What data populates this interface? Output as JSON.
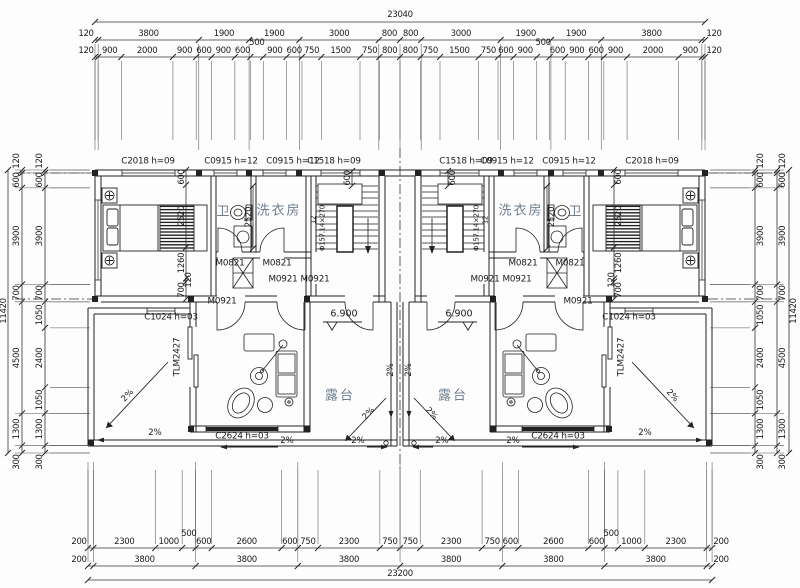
{
  "drawing": {
    "type": "architectural-floor-plan",
    "overall_width_mm": "23040",
    "overall_depth_mm": "11420",
    "terrace_width_mm": "23200",
    "level_note": "6.900"
  },
  "colors": {
    "line": "#222222",
    "room_text": "#6e7e8e"
  },
  "dim_rows": [
    {
      "id": "top-total",
      "dir": "h",
      "y": 22,
      "x0": 95,
      "s": 0.026476,
      "vals": [
        23040
      ],
      "lo": -7
    },
    {
      "id": "top-row1",
      "dir": "h",
      "y": 40,
      "x0": 95,
      "s": 0.026476,
      "lo": -6,
      "out": true,
      "ext": [
        44,
        150
      ],
      "vals": [
        120,
        3800,
        1900,
        1900,
        3000,
        800,
        800,
        3000,
        1900,
        1900,
        3800,
        120
      ]
    },
    {
      "id": "top-row2",
      "dir": "h",
      "y": 57,
      "x0": 95,
      "s": 0.025804,
      "lo": -6,
      "out": true,
      "ext": [
        61,
        140
      ],
      "raised": [
        7,
        20
      ],
      "vals": [
        120,
        900,
        2000,
        900,
        600,
        900,
        600,
        500,
        900,
        600,
        750,
        1500,
        750,
        800,
        800,
        750,
        1500,
        750,
        600,
        900,
        500,
        600,
        900,
        600,
        900,
        2000,
        900,
        120
      ]
    },
    {
      "id": "bottom-row1",
      "dir": "h",
      "y": 548,
      "x0": 88,
      "s": 0.0269,
      "lo": -6,
      "out": true,
      "ext": [
        470,
        544
      ],
      "raised": [
        3,
        16
      ],
      "vals": [
        200,
        2300,
        1000,
        500,
        600,
        2600,
        600,
        750,
        2300,
        750,
        750,
        2300,
        750,
        600,
        2600,
        600,
        500,
        1000,
        2300,
        200
      ]
    },
    {
      "id": "bottom-row2",
      "dir": "h",
      "y": 566,
      "x0": 88,
      "s": 0.0269,
      "lo": -6,
      "out": true,
      "ext": [
        462,
        562
      ],
      "vals": [
        200,
        3800,
        3800,
        3800,
        3800,
        3800,
        3800,
        200
      ]
    },
    {
      "id": "bottom-total",
      "dir": "h",
      "y": 580,
      "x0": 88,
      "s": 0.0269,
      "vals": [
        23200
      ],
      "lo": -6
    },
    {
      "id": "left-inner",
      "dir": "v",
      "x": 45,
      "y0": 170,
      "s": 0.02478,
      "lo": -5,
      "out": true,
      "ext": [
        50,
        90
      ],
      "vals": [
        120,
        600,
        3900,
        700,
        1050,
        2400,
        1050,
        1300,
        300
      ]
    },
    {
      "id": "left-outer",
      "dir": "v",
      "x": 22,
      "y0": 170,
      "s": 0.02478,
      "lo": -5,
      "out": true,
      "ext": [
        15,
        90
      ],
      "vals": [
        120,
        600,
        3900,
        700,
        4500,
        1300,
        300
      ]
    },
    {
      "id": "left-total",
      "dir": "v",
      "x": 8,
      "y0": 170,
      "s": 0.02478,
      "vals": [
        11420
      ],
      "lo": -4
    },
    {
      "id": "right-inner",
      "dir": "v",
      "x": 755,
      "y0": 170,
      "s": 0.02478,
      "lo": 6,
      "out": true,
      "ext": [
        710,
        750
      ],
      "vals": [
        120,
        600,
        3900,
        700,
        1050,
        2400,
        1050,
        1300,
        300
      ]
    },
    {
      "id": "right-outer",
      "dir": "v",
      "x": 777,
      "y0": 170,
      "s": 0.02478,
      "lo": 6,
      "out": true,
      "ext": [
        710,
        784
      ],
      "vals": [
        120,
        600,
        3900,
        700,
        4500,
        1300,
        300
      ]
    },
    {
      "id": "right-total",
      "dir": "v",
      "x": 789,
      "y0": 170,
      "s": 0.02478,
      "vals": [
        11420
      ],
      "lo": 5
    },
    {
      "id": "unitL-chain",
      "dir": "v",
      "x": 186,
      "y0": 170,
      "s": 0.0248,
      "lo": -4,
      "raised": [
        3
      ],
      "vals": [
        600,
        2520,
        1260,
        120,
        700
      ]
    },
    {
      "id": "unitR-chain",
      "dir": "v",
      "x": 614,
      "y0": 170,
      "s": 0.0248,
      "lo": 5,
      "raised": [
        3
      ],
      "vals": [
        600,
        2520,
        1260,
        120,
        700
      ]
    },
    {
      "id": "unitL-2520",
      "dir": "v",
      "x": 253,
      "y0": 186,
      "s": 0.0248,
      "lo": -4,
      "vals": [
        2520
      ]
    },
    {
      "id": "unitR-2520",
      "dir": "v",
      "x": 547,
      "y0": 186,
      "s": 0.0248,
      "lo": 5,
      "vals": [
        2520
      ]
    },
    {
      "id": "unitL-600",
      "dir": "v",
      "x": 352,
      "y0": 171,
      "s": 0.0248,
      "lo": -4,
      "vals": [
        600
      ]
    },
    {
      "id": "unitR-600",
      "dir": "v",
      "x": 448,
      "y0": 171,
      "s": 0.0248,
      "lo": 5,
      "vals": [
        600
      ]
    }
  ],
  "labels": [
    {
      "t": "C2018 h=09",
      "x": 148,
      "y": 162,
      "cls": "tag",
      "n": "window-tag"
    },
    {
      "t": "C0915 h=12",
      "x": 231,
      "y": 162,
      "cls": "tag",
      "n": "window-tag"
    },
    {
      "t": "C0915 h=12",
      "x": 293,
      "y": 162,
      "cls": "tag",
      "n": "window-tag"
    },
    {
      "t": "C1518 h=09",
      "x": 334,
      "y": 162,
      "cls": "tag",
      "n": "window-tag"
    },
    {
      "t": "C1518 h=09",
      "x": 466,
      "y": 162,
      "cls": "tag",
      "n": "window-tag"
    },
    {
      "t": "C0915 h=12",
      "x": 507,
      "y": 162,
      "cls": "tag",
      "n": "window-tag"
    },
    {
      "t": "C0915 h=12",
      "x": 569,
      "y": 162,
      "cls": "tag",
      "n": "window-tag"
    },
    {
      "t": "C2018 h=09",
      "x": 652,
      "y": 162,
      "cls": "tag",
      "n": "window-tag"
    },
    {
      "t": "M0821",
      "x": 230,
      "y": 264,
      "cls": "door",
      "n": "door-tag"
    },
    {
      "t": "M0821",
      "x": 277,
      "y": 264,
      "cls": "door",
      "n": "door-tag"
    },
    {
      "t": "M0921",
      "x": 283,
      "y": 280,
      "cls": "door",
      "n": "door-tag"
    },
    {
      "t": "M0921",
      "x": 315,
      "y": 280,
      "cls": "door",
      "n": "door-tag"
    },
    {
      "t": "M0921",
      "x": 222,
      "y": 302,
      "cls": "door",
      "n": "door-tag"
    },
    {
      "t": "M0821",
      "x": 570,
      "y": 264,
      "cls": "door",
      "n": "door-tag"
    },
    {
      "t": "M0821",
      "x": 523,
      "y": 264,
      "cls": "door",
      "n": "door-tag"
    },
    {
      "t": "M0921",
      "x": 517,
      "y": 280,
      "cls": "door",
      "n": "door-tag"
    },
    {
      "t": "M0921",
      "x": 485,
      "y": 280,
      "cls": "door",
      "n": "door-tag"
    },
    {
      "t": "M0921",
      "x": 578,
      "y": 302,
      "cls": "door",
      "n": "door-tag"
    },
    {
      "t": "卫",
      "x": 224,
      "y": 212,
      "cls": "room",
      "n": "room-label-bath"
    },
    {
      "t": "洗衣房",
      "x": 279,
      "y": 211,
      "cls": "room",
      "n": "room-label-laundry"
    },
    {
      "t": "卫",
      "x": 576,
      "y": 212,
      "cls": "room",
      "n": "room-label-bath"
    },
    {
      "t": "洗衣房",
      "x": 521,
      "y": 211,
      "cls": "room",
      "n": "room-label-laundry"
    },
    {
      "t": "露台",
      "x": 340,
      "y": 396,
      "cls": "room",
      "n": "room-label-terrace"
    },
    {
      "t": "露台",
      "x": 453,
      "y": 396,
      "cls": "room",
      "n": "room-label-terrace"
    },
    {
      "t": "6.900",
      "x": 344,
      "y": 314,
      "cls": "level",
      "n": "level-label"
    },
    {
      "t": "6.900",
      "x": 459,
      "y": 314,
      "cls": "level",
      "n": "level-label"
    },
    {
      "t": "C1024 h=03",
      "x": 171,
      "y": 318,
      "cls": "tag",
      "n": "window-tag"
    },
    {
      "t": "C1024 h=03",
      "x": 629,
      "y": 318,
      "cls": "tag",
      "n": "window-tag"
    },
    {
      "t": "TLM2427",
      "x": 178,
      "y": 357,
      "r": -90,
      "cls": "tag",
      "n": "door-tag"
    },
    {
      "t": "TLM2427",
      "x": 622,
      "y": 357,
      "r": -90,
      "cls": "tag",
      "n": "door-tag"
    },
    {
      "t": "C2624 h=03",
      "x": 242,
      "y": 437,
      "cls": "tag",
      "n": "window-tag"
    },
    {
      "t": "C2624 h=03",
      "x": 558,
      "y": 437,
      "cls": "tag",
      "n": "window-tag"
    },
    {
      "t": "Φ157.14×270",
      "x": 323,
      "y": 228,
      "r": -90,
      "cls": "stair",
      "n": "stair-note"
    },
    {
      "t": "12",
      "x": 314,
      "y": 220,
      "r": -90,
      "cls": "stair",
      "n": "stair-note"
    },
    {
      "t": "Φ157.14×270",
      "x": 477,
      "y": 228,
      "r": -90,
      "cls": "stair",
      "n": "stair-note"
    },
    {
      "t": "12",
      "x": 486,
      "y": 220,
      "r": -90,
      "cls": "stair",
      "n": "stair-note"
    },
    {
      "t": "2%",
      "x": 128,
      "y": 396,
      "r": -47,
      "cls": "slope",
      "n": "slope-label"
    },
    {
      "t": "2%",
      "x": 155,
      "y": 433,
      "cls": "slope",
      "n": "slope-label"
    },
    {
      "t": "2%",
      "x": 287,
      "y": 441,
      "cls": "slope",
      "n": "slope-label"
    },
    {
      "t": "2%",
      "x": 358,
      "y": 441,
      "cls": "slope",
      "n": "slope-label"
    },
    {
      "t": "2%",
      "x": 391,
      "y": 370,
      "r": -90,
      "cls": "slope",
      "n": "slope-label"
    },
    {
      "t": "2%",
      "x": 369,
      "y": 414,
      "r": -47,
      "cls": "slope",
      "n": "slope-label"
    },
    {
      "t": "2%",
      "x": 672,
      "y": 396,
      "r": 47,
      "cls": "slope",
      "n": "slope-label"
    },
    {
      "t": "2%",
      "x": 645,
      "y": 433,
      "cls": "slope",
      "n": "slope-label"
    },
    {
      "t": "2%",
      "x": 513,
      "y": 441,
      "cls": "slope",
      "n": "slope-label"
    },
    {
      "t": "2%",
      "x": 442,
      "y": 441,
      "cls": "slope",
      "n": "slope-label"
    },
    {
      "t": "2%",
      "x": 409,
      "y": 370,
      "r": -90,
      "cls": "slope",
      "n": "slope-label"
    },
    {
      "t": "2%",
      "x": 431,
      "y": 414,
      "r": 47,
      "cls": "slope",
      "n": "slope-label"
    }
  ]
}
